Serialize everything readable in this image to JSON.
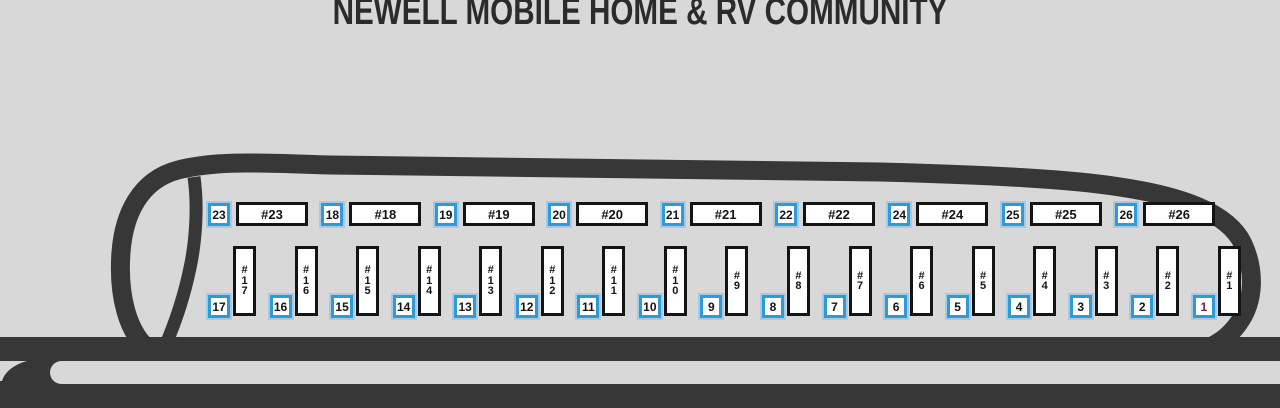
{
  "title": "NEWELL MOBILE HOME & RV COMMUNITY",
  "colors": {
    "background": "#d8d8d8",
    "road": "#373737",
    "badge_border": "#2f9ad6",
    "badge_halo": "#7dc0eb",
    "lot_border": "#141414",
    "badge_text": "#141414",
    "visited_badge_text": "#7b2044",
    "title_text": "#2b2b2b"
  },
  "top_row": [
    {
      "badge": "23",
      "lot": "#23"
    },
    {
      "badge": "18",
      "lot": "#18"
    },
    {
      "badge": "19",
      "lot": "#19"
    },
    {
      "badge": "20",
      "lot": "#20"
    },
    {
      "badge": "21",
      "lot": "#21"
    },
    {
      "badge": "22",
      "lot": "#22"
    },
    {
      "badge": "24",
      "lot": "#24"
    },
    {
      "badge": "25",
      "lot": "#25"
    },
    {
      "badge": "26",
      "lot": "#26"
    }
  ],
  "bottom_row": [
    {
      "badge": "17",
      "lot": "#17"
    },
    {
      "badge": "16",
      "lot": "#16"
    },
    {
      "badge": "15",
      "lot": "#15"
    },
    {
      "badge": "14",
      "lot": "#14"
    },
    {
      "badge": "13",
      "lot": "#13"
    },
    {
      "badge": "12",
      "lot": "#12"
    },
    {
      "badge": "11",
      "lot": "#11"
    },
    {
      "badge": "10",
      "lot": "#10"
    },
    {
      "badge": "9",
      "lot": "#9"
    },
    {
      "badge": "8",
      "lot": "#8"
    },
    {
      "badge": "7",
      "lot": "#7"
    },
    {
      "badge": "6",
      "lot": "#6"
    },
    {
      "badge": "5",
      "lot": "#5"
    },
    {
      "badge": "4",
      "lot": "#4"
    },
    {
      "badge": "3",
      "lot": "#3"
    },
    {
      "badge": "2",
      "lot": "#2"
    },
    {
      "badge": "1",
      "lot": "#1",
      "badge_text_color": "#7b2044"
    }
  ]
}
